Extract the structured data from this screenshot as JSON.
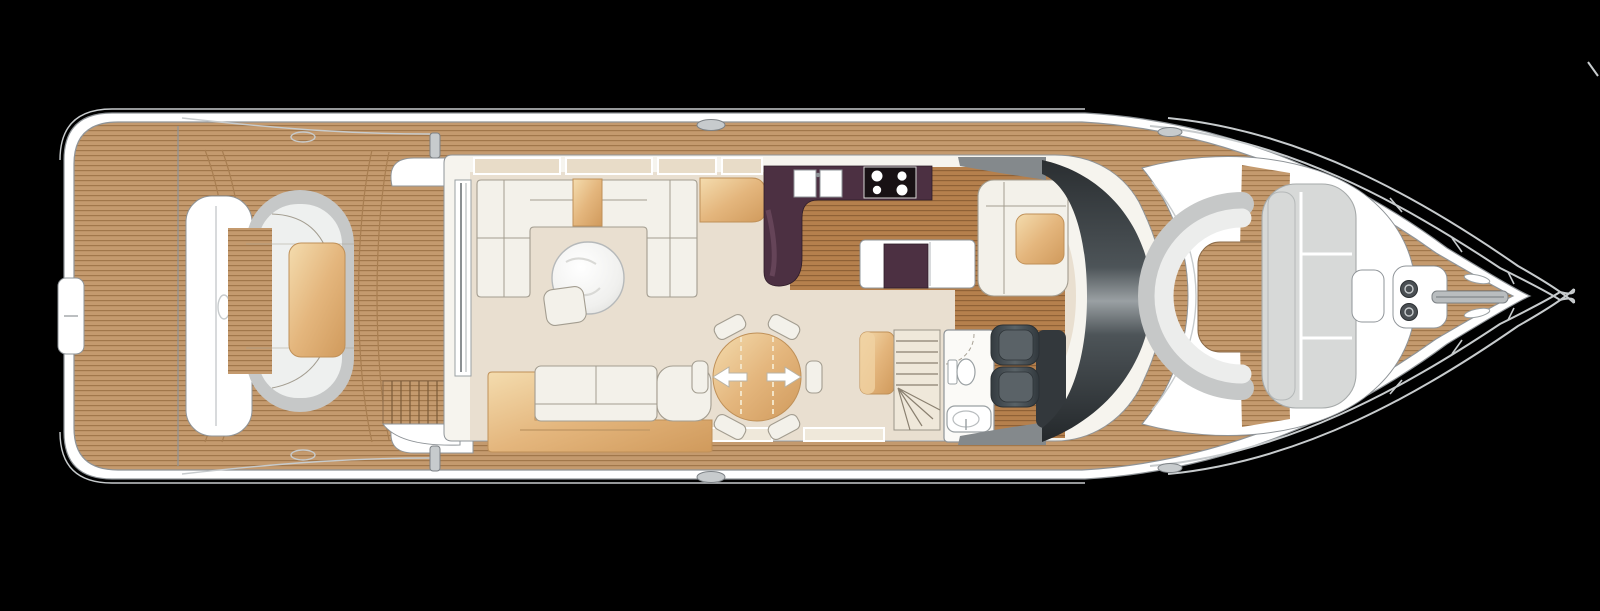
{
  "meta": {
    "drawing_type": "motor-yacht main deck floor plan",
    "view": "top-down plan view, bow pointing right",
    "background_color": "#000000"
  },
  "palette": {
    "bg": "#000000",
    "hull": "#ffffff",
    "line": "#8f9498",
    "lineSoft": "#c7cbcd",
    "teakBase": "#c49a6e",
    "teakLine": "#a1774b",
    "woodBase": "#b5804d",
    "woodLine": "#8f6136",
    "cream": "#e9dfd0",
    "wallFill": "#f6f4ee",
    "sofa": "#f3f1ea",
    "sofaLine": "#a39d90",
    "gray1": "#c6c8c8",
    "grayCushion": "#eef0ef",
    "aubergine": "#4c3042",
    "hobBlack": "#181114",
    "seatDark": "#40474c",
    "padGray": "#d7d9d8",
    "tanLight": "#f0d2a2",
    "tanDark": "#d9a666",
    "windshieldDark": "#2a2e31",
    "windshieldHighlight": "#9aa0a3"
  },
  "regions": [
    {
      "name": "swim-platform",
      "features": [
        "teak planking",
        "transom-gate"
      ]
    },
    {
      "name": "aft-cockpit",
      "features": [
        "transom-seat-unit",
        "c-shaped-sofa",
        "cocktail-table",
        "port-side-steps",
        "flybridge-overhang-outline"
      ]
    },
    {
      "name": "salon",
      "features": [
        "u-shaped-sofa",
        "round-marble-coffee-table",
        "ottoman",
        "aft-sofa-with-sideboard",
        "sliding-glass-door",
        "side-windows"
      ]
    },
    {
      "name": "dining",
      "features": [
        "round-extending-table",
        "extension-arrows",
        "six-chairs"
      ]
    },
    {
      "name": "galley",
      "features": [
        "l-shaped-aubergine-counter",
        "double-sink",
        "four-burner-hob",
        "island-unit",
        "wood-floor"
      ]
    },
    {
      "name": "companionway",
      "features": [
        "curved-staircase-down",
        "bench"
      ]
    },
    {
      "name": "day-head",
      "features": [
        "toilet",
        "washbasin",
        "door-swing-arc"
      ]
    },
    {
      "name": "helm",
      "features": [
        "twin-helm-seats",
        "companion-l-seat",
        "table",
        "dark-curved-windscreen",
        "console"
      ]
    },
    {
      "name": "foredeck-lounge",
      "features": [
        "c-shaped-seat-back",
        "teak-well",
        "sun-pad",
        "side-step"
      ]
    },
    {
      "name": "bow",
      "features": [
        "anchor-windlass",
        "twin-warping-drums",
        "chain-roller",
        "pulpit-rails",
        "deck-hatches"
      ]
    },
    {
      "name": "side-decks",
      "features": [
        "teak-walkways",
        "cleats",
        "fairleads"
      ]
    }
  ]
}
